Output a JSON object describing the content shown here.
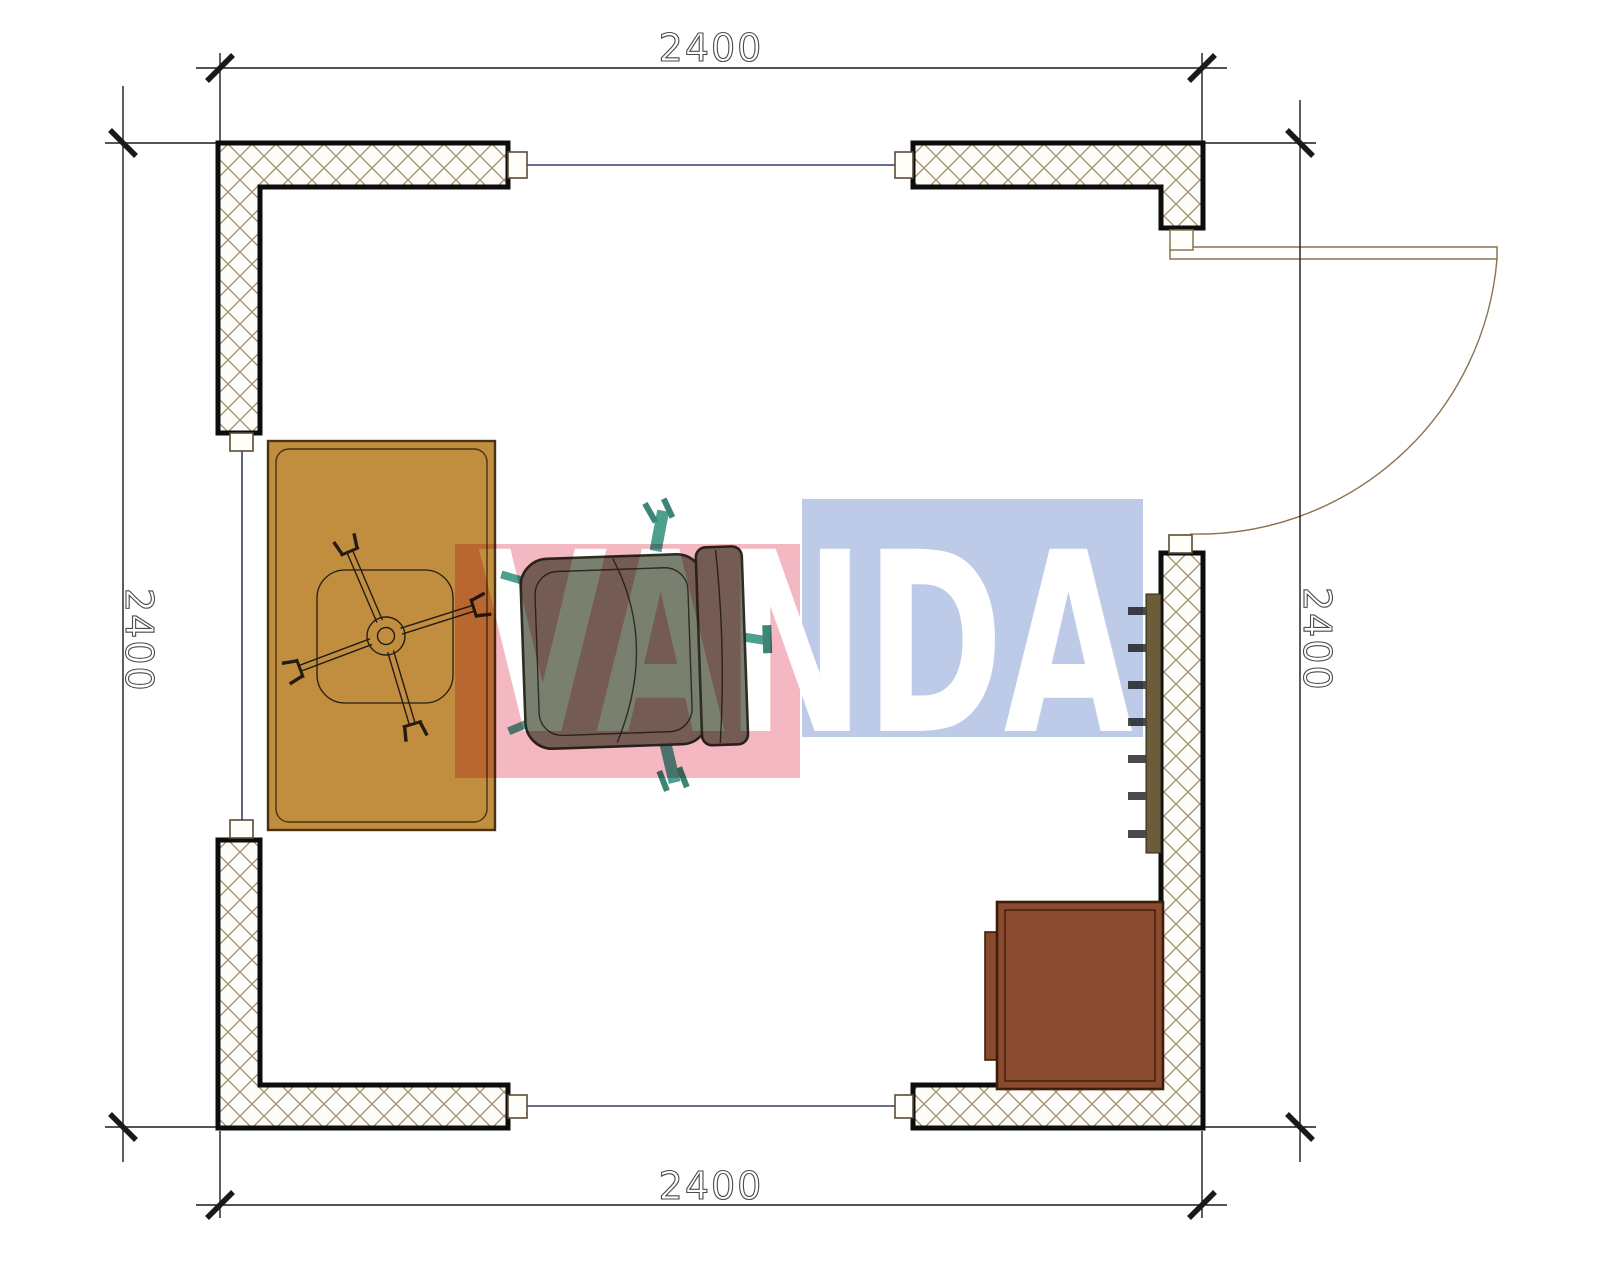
{
  "drawing": {
    "type_label": "floor-plan",
    "dimensions": {
      "top": "2400",
      "bottom": "2400",
      "left": "2400",
      "right": "2400"
    },
    "watermark": {
      "text": "VANDA",
      "pink_color": "#f3b8c1",
      "blue_color": "#bdcbe9"
    },
    "colors": {
      "desk": "#c18e3f",
      "desk_outline": "#4a3110",
      "chair_body": "#7a8070",
      "chair_outline": "#2d2d21",
      "chair_accent": "#4f9f8e",
      "cabinet": "#8a4a30",
      "cabinet_outline": "#3f1d08",
      "radiator": "#6b5c3a",
      "radiator_tick": "#4a4a48",
      "wall_hatch": "#a3906f",
      "wall_outline": "#0d0d0d",
      "window_line": "#3a3a6e",
      "door": "#8a7350",
      "dimension_line": "#1a1a1a"
    }
  }
}
